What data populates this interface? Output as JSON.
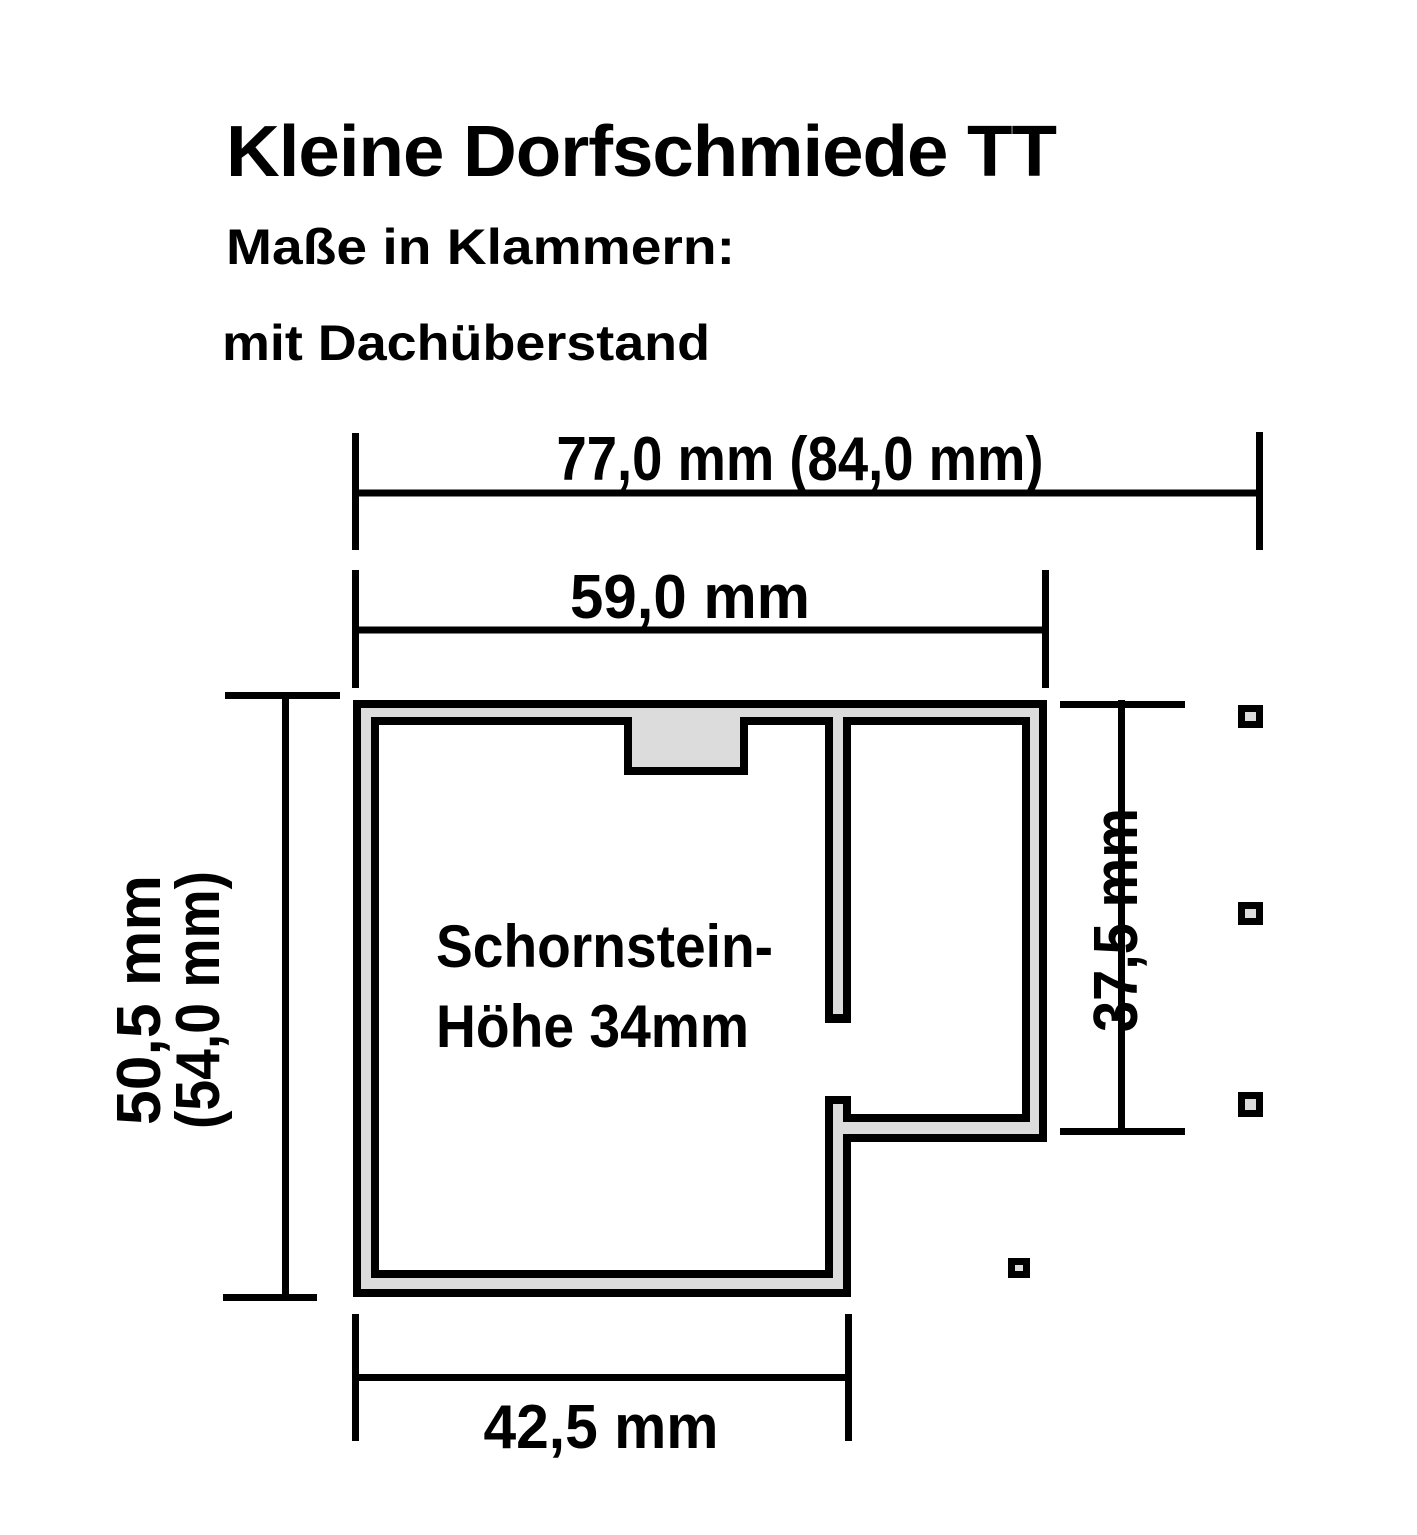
{
  "header": {
    "title": "Kleine Dorfschmiede TT",
    "subtitle_line1": "Maße in Klammern:",
    "subtitle_line2": "mit Dachüberstand"
  },
  "dimensions": {
    "top_outer": "77,0 mm (84,0 mm)",
    "top_inner": "59,0 mm",
    "left": "50,5 mm",
    "left_parenthesized": "(54,0 mm)",
    "right": "37,5 mm",
    "bottom": "42,5 mm"
  },
  "floorplan": {
    "note_line1": "Schornstein-",
    "note_line2": "Höhe 34mm"
  },
  "colors": {
    "line": "#000000",
    "wall_fill": "#dcdcdc",
    "background": "#ffffff"
  }
}
